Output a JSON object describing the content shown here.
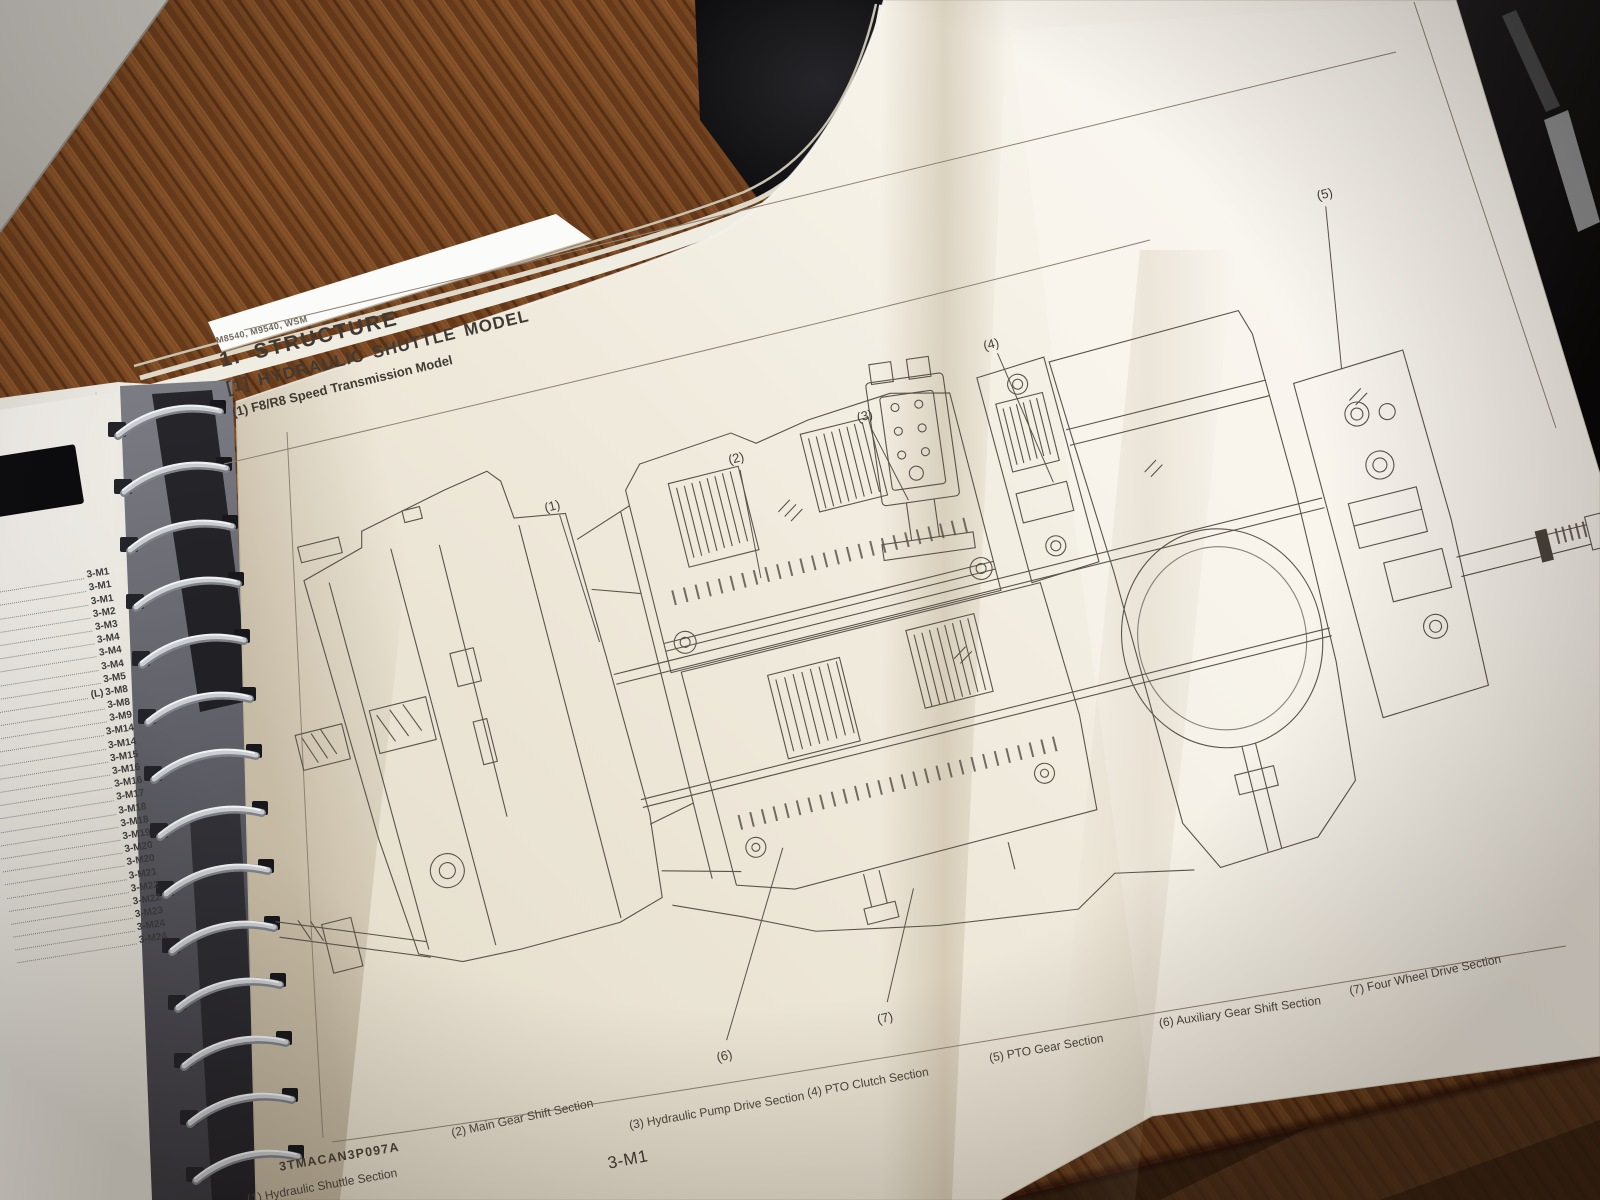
{
  "colors": {
    "paper": "#efe9db",
    "ink": "#3f3a33",
    "drawing_line": "#5a534a",
    "wood_floor": "#7c4a23",
    "dark_wood": "#3f2817",
    "wall": "#c9c6c0",
    "spiral_coil": "#c9ccd1"
  },
  "left_page": {
    "toc_prefix": "(L)",
    "toc_refs": [
      "3-M1",
      "3-M1",
      "3-M1",
      "3-M2",
      "3-M3",
      "3-M4",
      "3-M4",
      "3-M4",
      "3-M5",
      "3-M8",
      "3-M8",
      "3-M9",
      "3-M14",
      "3-M14",
      "3-M15",
      "3-M16",
      "3-M16",
      "3-M17",
      "3-M18",
      "3-M18",
      "3-M19",
      "3-M20",
      "3-M20",
      "3-M21",
      "3-M22",
      "3-M22",
      "3-M23",
      "3-M24",
      "3-M24"
    ]
  },
  "right_page": {
    "header": "M8540, M9540, WSM",
    "section_title": "1. STRUCTURE",
    "subsection_title": "[1] HYDRAULIC SHUTTLE MODEL",
    "figure_title": "(1) F8/R8 Speed Transmission Model",
    "figure_code": "3TMACAN3P097A",
    "page_number": "3-M1",
    "callouts": [
      "(1)",
      "(2)",
      "(3)",
      "(4)",
      "(5)",
      "(6)",
      "(7)"
    ],
    "captions": [
      "(1) Hydraulic Shuttle Section",
      "(2) Main Gear Shift Section",
      "(3) Hydraulic Pump Drive Section",
      "(4) PTO Clutch Section",
      "(5) PTO Gear Section",
      "(6) Auxiliary Gear Shift Section",
      "(7) Four Wheel Drive Section"
    ]
  }
}
